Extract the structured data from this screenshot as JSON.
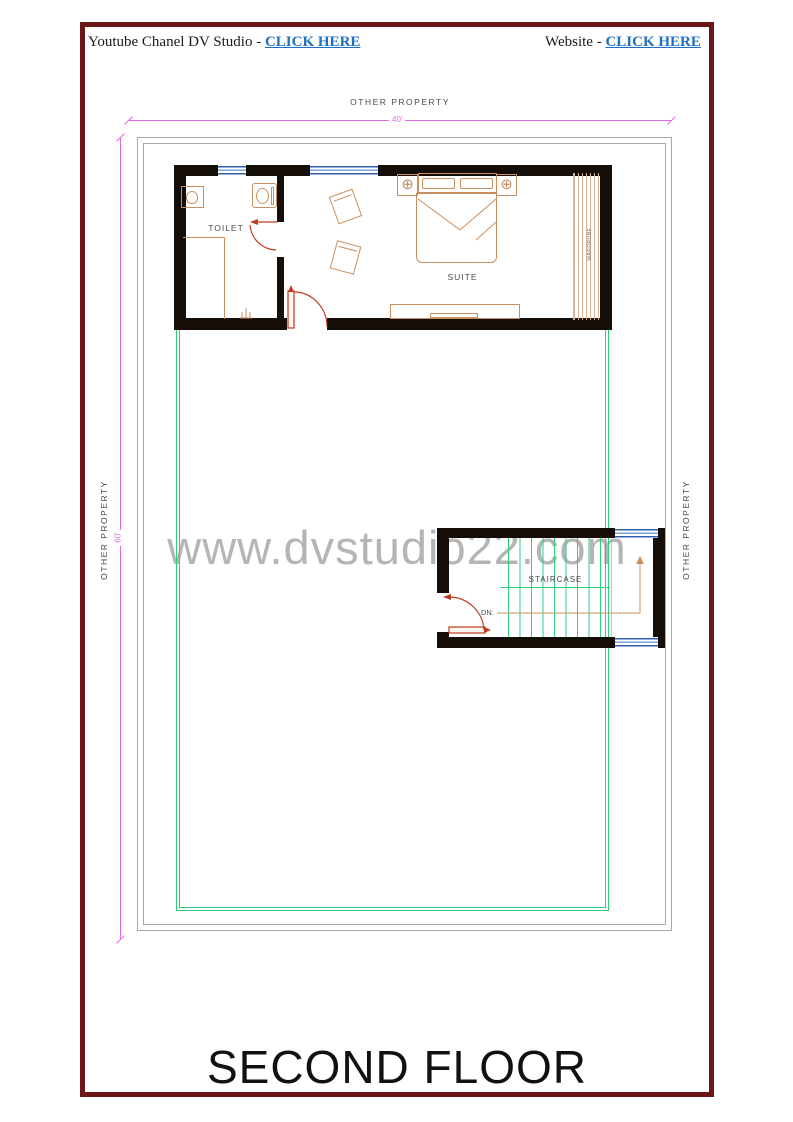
{
  "header": {
    "left_prefix": "Youtube Chanel DV Studio - ",
    "left_link": "CLICK HERE",
    "right_prefix": "Website - ",
    "right_link": "CLICK HERE",
    "link_color": "#1f6fc0"
  },
  "watermark": {
    "text": "www.dvstudio22.com",
    "color": "#a3a3a3"
  },
  "plan": {
    "boundary_labels": {
      "top": "OTHER PROPERTY",
      "left": "OTHER PROPERTY",
      "right": "OTHER PROPERTY"
    },
    "dimensions": {
      "width": "40'",
      "height": "60'",
      "color": "#e06ae0"
    },
    "rooms": {
      "toilet": "TOILET",
      "suite": "SUITE",
      "staircase": "STAIRCASE",
      "down": "DN.",
      "wardrobe": "WARDROBE"
    },
    "colors": {
      "wall": "#150d08",
      "window": "#2e5fae",
      "door": "#c03a20",
      "furniture": "#c98f5e",
      "terrace_line": "#2fcf7d",
      "boundary_line": "#a8a8a8",
      "page_border": "#6b1717"
    }
  },
  "footer": {
    "title": "SECOND FLOOR"
  }
}
